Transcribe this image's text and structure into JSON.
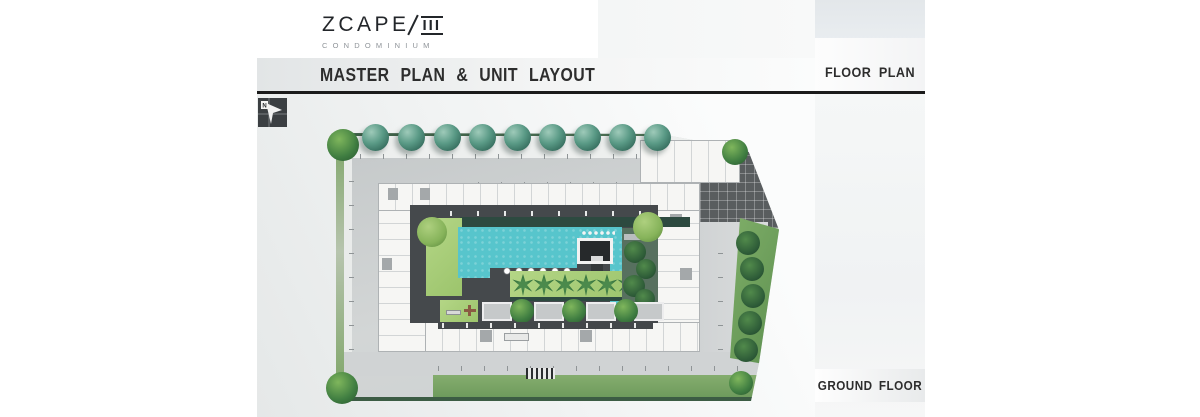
{
  "brand": {
    "name": "ZCAPE",
    "numeral": "III",
    "subtitle": "CONDOMINIUM"
  },
  "header": {
    "title": "MASTER PLAN & UNIT LAYOUT"
  },
  "right_panel": {
    "floor_plan_label": "FLOOR PLAN",
    "ground_floor_label": "GROUND FLOOR"
  },
  "compass": {
    "letter": "N"
  },
  "plan": {
    "view": "ground floor master plan",
    "features": [
      "tree-lined-frontage",
      "perimeter-driveway",
      "parking-bays",
      "residential-wings",
      "swimming-pool",
      "pool-pavilion",
      "sun-loungers",
      "palm-garden",
      "private-terraces",
      "paved-entry-court",
      "landscaped-boundary"
    ],
    "colors": {
      "pool": "#57c5cc",
      "lawn": "#a9cf79",
      "deck": "#45494c",
      "driveway": "#cfd2d3",
      "tree_teal": "#5a9a86",
      "tree_green": "#3f7d41",
      "divider_line": "#1b1b1b"
    }
  }
}
